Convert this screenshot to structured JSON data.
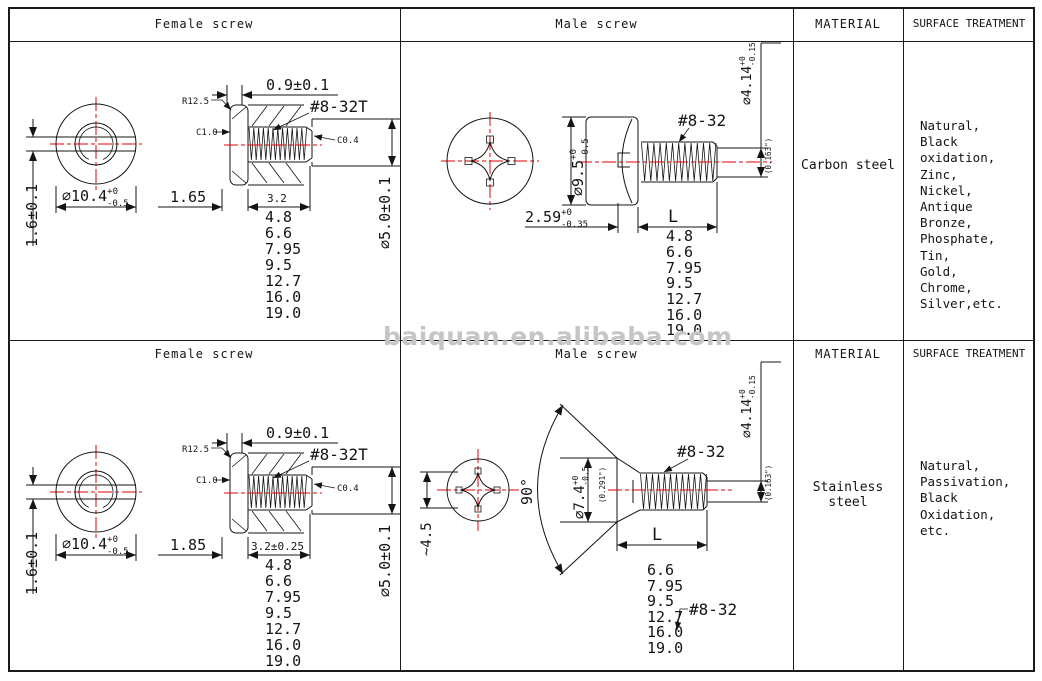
{
  "watermark": "baiquan.en.alibaba.com",
  "colors": {
    "accent_red": "#e60000",
    "line": "#1a1a1a",
    "watermark_gray": "#c5c5c5"
  },
  "rows": [
    {
      "headers": {
        "female": "Female screw",
        "male": "Male screw",
        "material": "MATERIAL",
        "surface": "SURFACE TREATMENT"
      },
      "material": "Carbon steel",
      "surface": "Natural,\nBlack oxidation,\nZinc,\nNickel,\nAntique Bronze,\nPhosphate,\nTin,\nGold,\nChrome,\nSilver,etc.",
      "female": {
        "head_rim": "0.9±0.1",
        "radius_label": "R12.5",
        "chamfer_face": "C1.0",
        "thread": "#8-32T",
        "chamfer_end": "C0.4",
        "slot_height": "1.6±0.1",
        "outer_dia": "∅10.4",
        "outer_tol_p": "+0",
        "outer_tol_m": "-0.5",
        "base_len": "1.65",
        "thread_len": "3.2",
        "body_dia": "∅5.0±0.1",
        "lengths": [
          "4.8",
          "6.6",
          "7.95",
          "9.5",
          "12.7",
          "16.0",
          "19.0"
        ]
      },
      "male": {
        "head_dia": "∅9.5",
        "head_tol_p": "+0",
        "head_tol_m": "-0.5",
        "thread": "#8-32",
        "shaft_dia": "∅4.14",
        "shaft_tol_p": "+0",
        "shaft_tol_m": "-0.15",
        "shaft_inch": "(0.163\")",
        "head_h": "2.59",
        "head_h_tol_p": "+0",
        "head_h_tol_m": "-0.35",
        "len_label": "L",
        "lengths": [
          "4.8",
          "6.6",
          "7.95",
          "9.5",
          "12.7",
          "16.0",
          "19.0"
        ]
      }
    },
    {
      "headers": {
        "female": "Female screw",
        "male": "Male screw",
        "material": "MATERIAL",
        "surface": "SURFACE TREATMENT"
      },
      "material": "Stainless steel",
      "surface": "Natural,\nPassivation,\nBlack Oxidation,\netc.",
      "female": {
        "head_rim": "0.9±0.1",
        "radius_label": "R12.5",
        "chamfer_face": "C1.0",
        "thread": "#8-32T",
        "chamfer_end": "C0.4",
        "slot_height": "1.6±0.1",
        "outer_dia": "∅10.4",
        "outer_tol_p": "+0",
        "outer_tol_m": "-0.5",
        "base_len": "1.85",
        "thread_len": "3.2±0.25",
        "body_dia": "∅5.0±0.1",
        "lengths": [
          "4.8",
          "6.6",
          "7.95",
          "9.5",
          "12.7",
          "16.0",
          "19.0"
        ]
      },
      "male": {
        "angle": "90°",
        "cross_width": "~4.5",
        "head_dia": "∅7.4",
        "head_tol_p": "+0",
        "head_tol_m": "-0.5",
        "head_inch": "(0.291\")",
        "thread": "#8-32",
        "thread2": "#8-32",
        "shaft_dia": "∅4.14",
        "shaft_tol_p": "+0",
        "shaft_tol_m": "-0.15",
        "shaft_inch": "(0.163\")",
        "len_label": "L",
        "lengths": [
          "6.6",
          "7.95",
          "9.5",
          "12.7",
          "16.0",
          "19.0"
        ]
      }
    }
  ]
}
